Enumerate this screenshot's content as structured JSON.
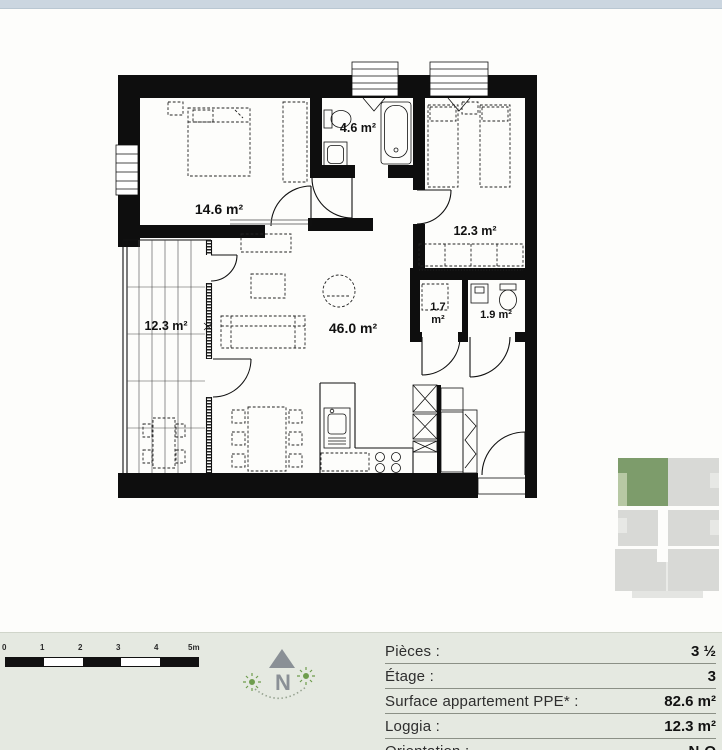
{
  "colors": {
    "top_strip": "#cbd6e0",
    "footer_bg": "#e5e9e1",
    "plan_wall": "#0e0e0e",
    "site_highlight_green": "#7d9c6b",
    "site_light_green": "#b7c8a4",
    "site_gray": "#d8d9d6",
    "compass_gray": "#8a9096",
    "sun_green": "#6f9d4e"
  },
  "floor_plan": {
    "rooms": [
      {
        "id": "bedroom-1",
        "area": "14.6 m²"
      },
      {
        "id": "bathroom",
        "area": "4.6 m²"
      },
      {
        "id": "bedroom-2",
        "area": "12.3 m²"
      },
      {
        "id": "living-dining-kitchen",
        "area": "46.0 m²"
      },
      {
        "id": "reduit",
        "area_value": "1.7",
        "area_unit": "m²"
      },
      {
        "id": "wc",
        "area": "1.9 m²"
      },
      {
        "id": "loggia",
        "area": "12.3 m²"
      }
    ]
  },
  "scale_bar": {
    "labels": [
      "0",
      "1",
      "2",
      "3",
      "4",
      "5m"
    ]
  },
  "compass": {
    "north_label": "N"
  },
  "info_table": {
    "rows": [
      {
        "label": "Pièces :",
        "value": "3 ½"
      },
      {
        "label": "Étage :",
        "value": "3"
      },
      {
        "label": "Surface appartement PPE* :",
        "value": "82.6 m²"
      },
      {
        "label": "Loggia :",
        "value": "12.3 m²"
      },
      {
        "label": "Orientation :",
        "value": "N-O"
      }
    ]
  }
}
